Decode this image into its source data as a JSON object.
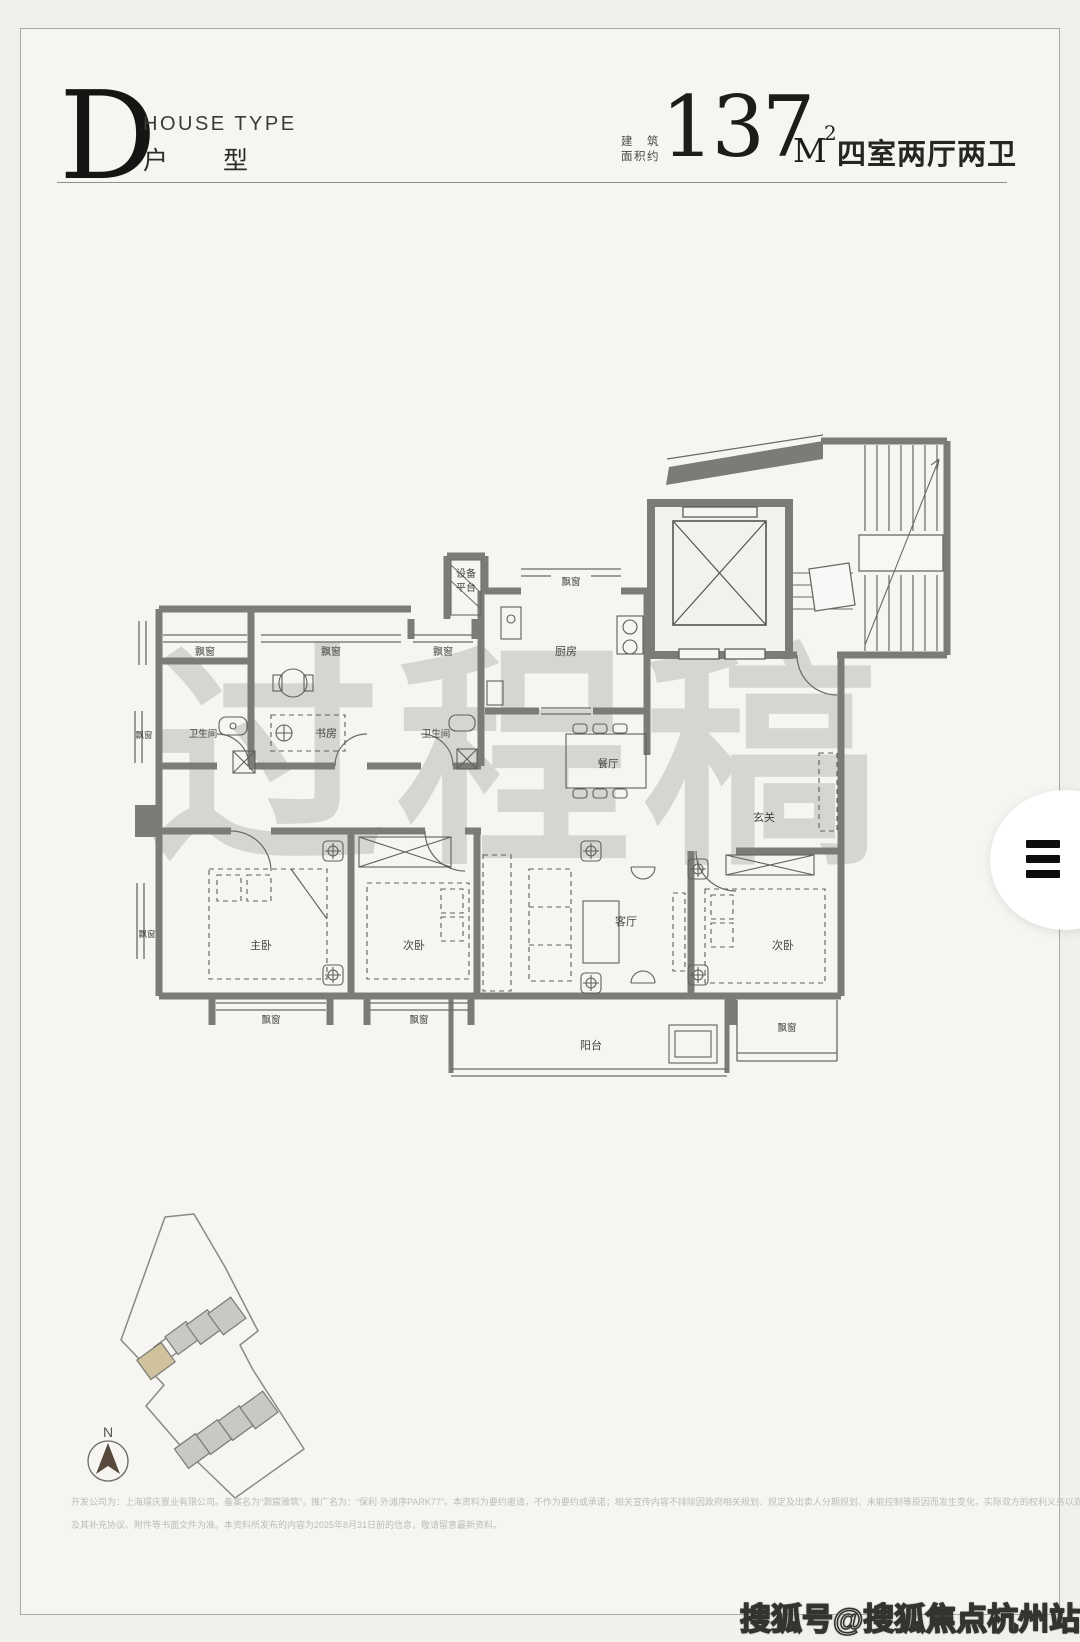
{
  "header": {
    "letter": "D",
    "subtitle_en": "HOUSE TYPE",
    "subtitle_cn": "户型",
    "area_prefix_1": "建　筑",
    "area_prefix_2": "面积约",
    "area_value": "137",
    "area_unit": "M",
    "area_sup": "2",
    "spec": "四室两厅两卫"
  },
  "plan": {
    "watermark": "过程稿",
    "labels": {
      "equipment_1": "设备",
      "equipment_2": "平台",
      "bay": "飘窗",
      "bath": "卫生间",
      "study": "书房",
      "kitchen": "厨房",
      "dining": "餐厅",
      "foyer": "玄关",
      "living": "客厅",
      "master": "主卧",
      "bedroom2": "次卧",
      "bedroom3": "次卧",
      "balcony": "阳台"
    }
  },
  "siteplan": {
    "north": "N"
  },
  "footer": {
    "line1": "开发公司为：上海璟庆置业有限公司。备案名为“灏宸雅筑”，推广名为：“保利·外滩序PARK77”。本资料为要约邀请，不作为要约或承诺；相关宣传内容不排除因政府相关规划、规定及出卖人分期规划、未能控制等原因而发生变化，实际双方的权利义务以双方签订的《商品房买卖合同》",
    "line2": "及其补充协议、附件等书面文件为准。本资料所发布的内容为2025年8月31日前的信息，敬请留意最新资料。"
  },
  "overlay": {
    "sohu_badge": "搜狐号@搜狐焦点杭州站"
  },
  "colors": {
    "wall": "#7c7b78",
    "thin_line": "#6b6a66",
    "card_bg": "#f6f5f1",
    "highlight_building": "#cfc29c",
    "building_gray": "#cac8c3",
    "watermark_gray": "#a6a49e"
  }
}
